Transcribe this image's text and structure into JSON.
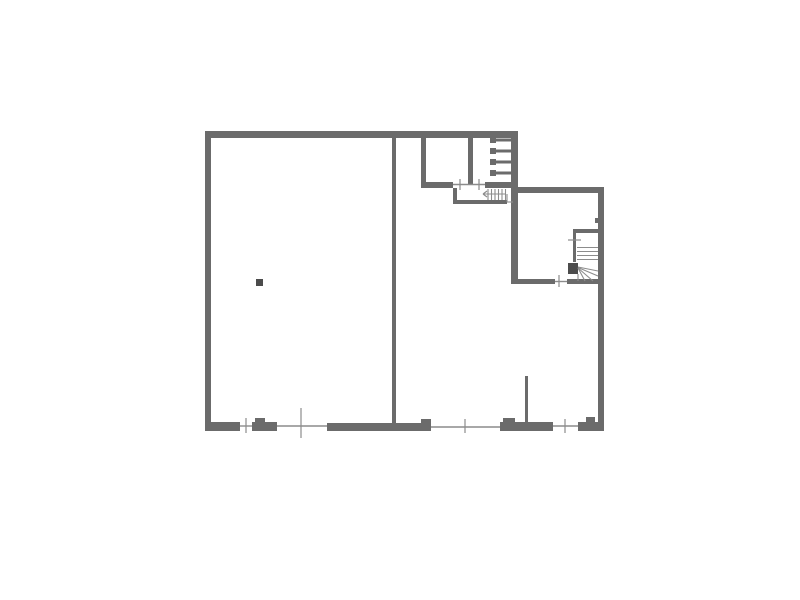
{
  "meta": {
    "drawing_type": "floor-plan",
    "canvas": {
      "width": 800,
      "height": 600,
      "background": "#ffffff"
    }
  },
  "palette": {
    "wall": "#6b6b6b",
    "dark": "#4c4c4c",
    "thin": "#8c8c8c"
  },
  "plan": {
    "rects": [
      [
        "top-wall",
        205,
        131,
        313,
        7,
        "wall"
      ],
      [
        "left-wall",
        205,
        138,
        6,
        292,
        "wall"
      ],
      [
        "bottom-wall-a",
        205,
        422,
        35,
        9,
        "wall"
      ],
      [
        "bottom-pier",
        252,
        422,
        25,
        9,
        "wall"
      ],
      [
        "bottom-pier-bump",
        255,
        418,
        10,
        4,
        "wall"
      ],
      [
        "bottom-wall-b",
        327,
        423,
        104,
        8,
        "wall"
      ],
      [
        "bottom-wall-b-bump",
        421,
        419,
        10,
        4,
        "wall"
      ],
      [
        "bottom-wall-c",
        500,
        422,
        53,
        9,
        "wall"
      ],
      [
        "bottom-wall-c-bump",
        503,
        418,
        12,
        4,
        "wall"
      ],
      [
        "bottom-wall-d",
        578,
        422,
        26,
        9,
        "wall"
      ],
      [
        "bottom-wall-d-step",
        586,
        417,
        9,
        5,
        "wall"
      ],
      [
        "right-wall",
        598,
        187,
        6,
        244,
        "wall"
      ],
      [
        "right-room-top-wall",
        511,
        187,
        93,
        6,
        "wall"
      ],
      [
        "center-vertical-wall",
        511,
        131,
        7,
        152,
        "wall"
      ],
      [
        "divider-wall",
        392,
        138,
        4,
        288,
        "wall"
      ],
      [
        "top-room-left-wall",
        421,
        138,
        5,
        48,
        "wall"
      ],
      [
        "top-room-inner-wall",
        468,
        138,
        5,
        46,
        "wall"
      ],
      [
        "upper-wall-left",
        421,
        182,
        32,
        6,
        "wall"
      ],
      [
        "upper-wall-right",
        485,
        182,
        27,
        6,
        "wall"
      ],
      [
        "small-stair-room-left-wall",
        453,
        188,
        4,
        16,
        "wall"
      ],
      [
        "small-stair-room-bottom-wall",
        453,
        200,
        54,
        4,
        "wall"
      ],
      [
        "stair-enclosure-top-wall",
        573,
        229,
        29,
        4,
        "wall"
      ],
      [
        "stair-enclosure-left-wall",
        573,
        233,
        3,
        29,
        "wall"
      ],
      [
        "right-room-bottom-wall-a",
        511,
        279,
        44,
        5,
        "wall"
      ],
      [
        "right-room-bottom-wall-b",
        567,
        279,
        37,
        5,
        "wall"
      ],
      [
        "newel-post",
        568,
        263,
        10,
        11,
        "dark"
      ],
      [
        "partition-wall",
        525,
        376,
        3,
        54,
        "wall"
      ],
      [
        "right-wall-notch",
        595,
        218,
        4,
        5,
        "wall"
      ],
      [
        "pillar",
        256,
        279,
        7,
        7,
        "dark"
      ],
      [
        "ladder-rung-1-end",
        490,
        137,
        6,
        6,
        "wall"
      ],
      [
        "ladder-rung-2-end",
        490,
        148,
        6,
        6,
        "wall"
      ],
      [
        "ladder-rung-3-end",
        490,
        159,
        6,
        6,
        "wall"
      ],
      [
        "ladder-rung-4-end",
        490,
        170,
        6,
        6,
        "wall"
      ],
      [
        "ladder-rung-1",
        496,
        138.5,
        16,
        3,
        "wall"
      ],
      [
        "ladder-rung-2",
        496,
        149.5,
        16,
        3,
        "wall"
      ],
      [
        "ladder-rung-3",
        496,
        160.5,
        16,
        3,
        "wall"
      ],
      [
        "ladder-rung-4",
        496,
        171.5,
        16,
        3,
        "wall"
      ]
    ],
    "lines": [
      [
        "window-line-1",
        240,
        426,
        252,
        426,
        "thin",
        1.4
      ],
      [
        "window-line-2",
        277,
        426,
        327,
        426,
        "thin",
        1.4
      ],
      [
        "window-line-3",
        431,
        427,
        500,
        427,
        "thin",
        1.4
      ],
      [
        "door-line-1",
        553,
        426,
        578,
        426,
        "thin",
        1.4
      ],
      [
        "door-line-2",
        555,
        281.5,
        567,
        281.5,
        "thin",
        1.4
      ],
      [
        "door-line-3",
        453,
        184.5,
        485,
        184.5,
        "thin",
        1.4
      ],
      [
        "opening-tick-1",
        246,
        418,
        246,
        433,
        "thin",
        1.2
      ],
      [
        "window-mullion",
        301,
        408,
        301,
        438,
        "thin",
        1.2
      ],
      [
        "opening-tick-2",
        465,
        419,
        465,
        433,
        "thin",
        1.2
      ],
      [
        "opening-tick-3",
        565,
        419,
        565,
        433,
        "thin",
        1.2
      ],
      [
        "door-tick-1a",
        460,
        179,
        460,
        190,
        "thin",
        1.2
      ],
      [
        "door-tick-1b",
        479,
        179,
        479,
        190,
        "thin",
        1.2
      ],
      [
        "door-tick-2",
        559,
        275,
        559,
        287,
        "thin",
        1.2
      ],
      [
        "stair-door-tick",
        568,
        240,
        581,
        240,
        "thin",
        1.2
      ],
      [
        "stair-tread-1",
        577,
        247.5,
        598,
        247.5,
        "thin",
        1.1
      ],
      [
        "stair-tread-2",
        577,
        251.5,
        598,
        251.5,
        "thin",
        1.1
      ],
      [
        "stair-tread-3",
        577,
        255.5,
        598,
        255.5,
        "thin",
        1.1
      ],
      [
        "stair-tread-4",
        577,
        259.5,
        598,
        259.5,
        "thin",
        1.1
      ],
      [
        "stair-winder-1",
        578,
        267,
        598,
        271,
        "thin",
        1.1
      ],
      [
        "stair-winder-2",
        578,
        267.5,
        598,
        276,
        "thin",
        1.1
      ],
      [
        "stair-winder-3",
        578,
        268,
        593,
        281,
        "thin",
        1.1
      ],
      [
        "stair-winder-4",
        578,
        268,
        585,
        281,
        "thin",
        1.1
      ],
      [
        "stair-winder-edge",
        578,
        274,
        578,
        281,
        "thin",
        1.1
      ],
      [
        "small-stair-riser-1",
        488,
        189,
        488,
        200,
        "thin",
        1.1
      ],
      [
        "small-stair-riser-2",
        491.5,
        189,
        491.5,
        200,
        "thin",
        1.1
      ],
      [
        "small-stair-riser-3",
        495,
        189,
        495,
        200,
        "thin",
        1.1
      ],
      [
        "small-stair-riser-4",
        498.5,
        189,
        498.5,
        200,
        "thin",
        1.1
      ],
      [
        "small-stair-riser-5",
        502,
        189,
        502,
        200,
        "thin",
        1.1
      ],
      [
        "small-stair-riser-6",
        505.5,
        189,
        505.5,
        200,
        "thin",
        1.1
      ],
      [
        "small-stair-arrow-shaft",
        483,
        194,
        506,
        194,
        "thin",
        1.1
      ],
      [
        "small-stair-arrow-head-a",
        483,
        194,
        487,
        191,
        "thin",
        1.1
      ],
      [
        "small-stair-arrow-head-b",
        483,
        194,
        487,
        197,
        "thin",
        1.1
      ],
      [
        "landing-line-v",
        507,
        194,
        507,
        202,
        "thin",
        1.1
      ],
      [
        "landing-line-h",
        507,
        202,
        513,
        202,
        "thin",
        1.1
      ]
    ]
  }
}
